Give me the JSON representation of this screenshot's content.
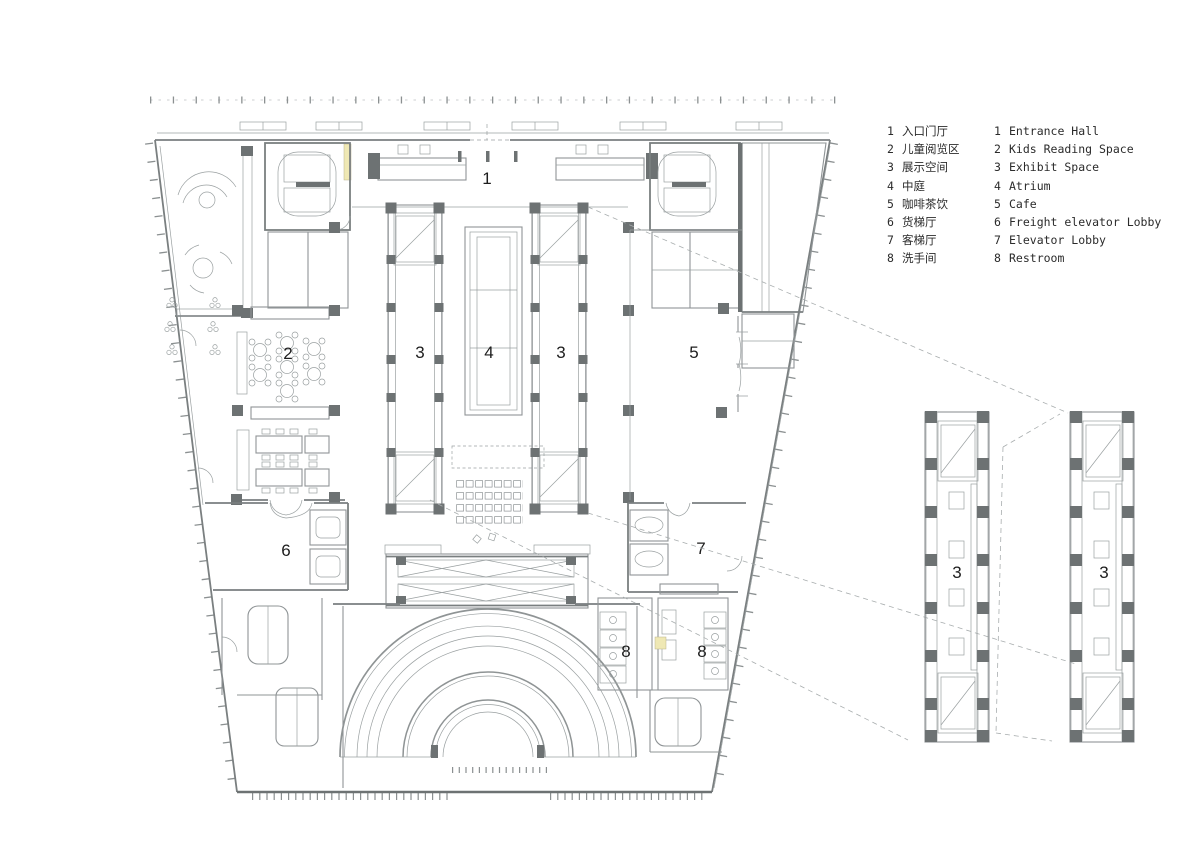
{
  "drawing": {
    "type": "library floor plan",
    "colors": {
      "line": "#8f9496",
      "wall": "#7a7f80",
      "column": "#6d7273",
      "highlight": "#efe8b4",
      "label": "#1d1d1d"
    }
  },
  "legend": {
    "items": [
      {
        "num": "1",
        "zh": "入口门厅",
        "en": "Entrance Hall"
      },
      {
        "num": "2",
        "zh": "儿童阅览区",
        "en": "Kids Reading Space"
      },
      {
        "num": "3",
        "zh": "展示空间",
        "en": "Exhibit Space"
      },
      {
        "num": "4",
        "zh": "中庭",
        "en": "Atrium"
      },
      {
        "num": "5",
        "zh": "咖啡茶饮",
        "en": "Cafe"
      },
      {
        "num": "6",
        "zh": "货梯厅",
        "en": "Freight elevator Lobby"
      },
      {
        "num": "7",
        "zh": "客梯厅",
        "en": "Elevator Lobby"
      },
      {
        "num": "8",
        "zh": "洗手间",
        "en": "Restroom"
      }
    ]
  },
  "plan_labels": {
    "entrance": "1",
    "kids": "2",
    "exhibit": "3",
    "atrium": "4",
    "cafe": "5",
    "freight": "6",
    "elevator": "7",
    "restroom": "8"
  }
}
